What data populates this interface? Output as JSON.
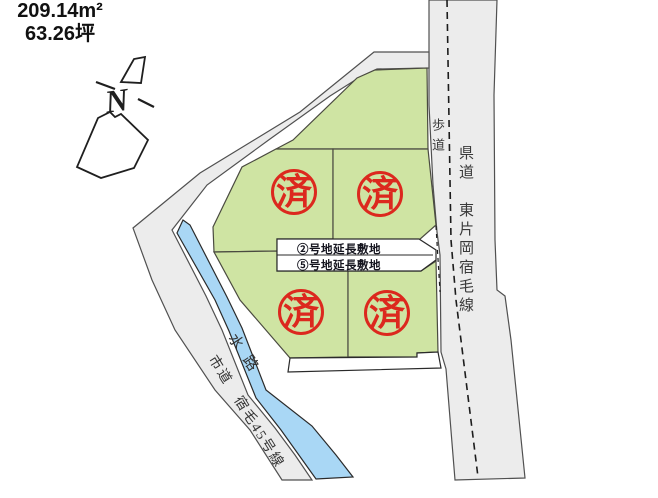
{
  "map": {
    "north_label": "N",
    "area_label": {
      "sqm": "209.14m²",
      "tsubo": "63.26坪"
    },
    "roads": {
      "sidewalk": "歩道",
      "prefectural": "県道　東片岡宿毛線",
      "city": "市道　宿毛45号線",
      "waterway": "水路"
    },
    "extensions": {
      "plot2": "②号地延長敷地",
      "plot5": "⑤号地延長敷地"
    },
    "sold_stamp": "済",
    "colors": {
      "plot_green": "#cfe4a3",
      "road_gray": "#ececec",
      "water_blue": "#a9d7f5",
      "stamp_red": "#dc281e",
      "line_dark": "#44443c"
    }
  }
}
